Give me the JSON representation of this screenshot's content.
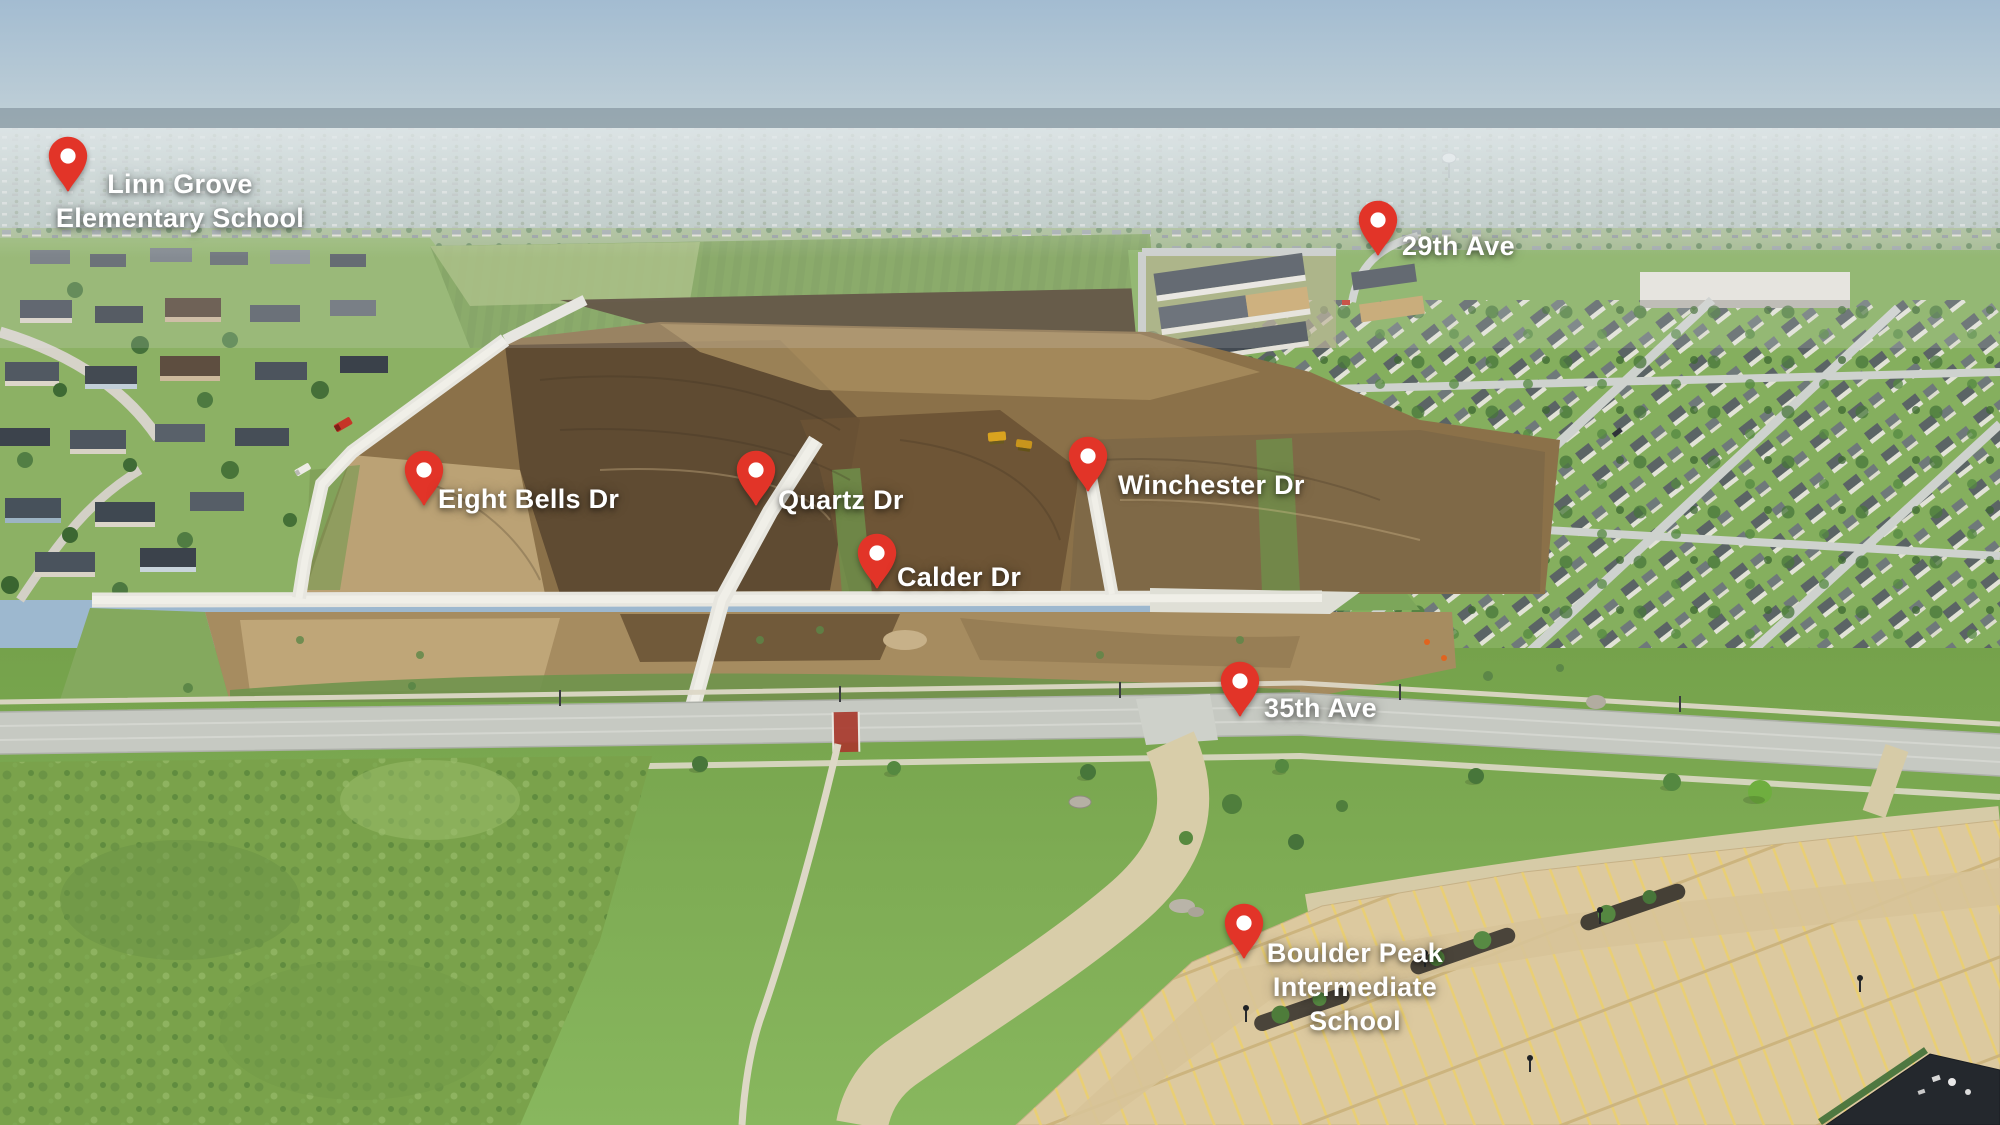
{
  "image": {
    "type": "annotated-aerial-photo",
    "description": "Aerial drone view of a residential construction development with labeled streets and schools"
  },
  "colors": {
    "pin": "#e23428",
    "pin_hole": "#ffffff",
    "label_text": "#ffffff",
    "sky": "#a3bcd1",
    "dirt": "#8b7149",
    "road_concrete": "#e7e6df",
    "asphalt": "#c6c9c2",
    "lawn": "#7aa74f",
    "parking_lot": "#dcc99f"
  },
  "markers": [
    {
      "id": "linn-grove-elementary",
      "label": "Linn Grove\nElementary School",
      "x": 68,
      "y": 193
    },
    {
      "id": "29th-ave",
      "label": "29th Ave",
      "x": 1378,
      "y": 257
    },
    {
      "id": "eight-bells-dr",
      "label": "Eight Bells Dr",
      "x": 424,
      "y": 507
    },
    {
      "id": "quartz-dr",
      "label": "Quartz Dr",
      "x": 756,
      "y": 507
    },
    {
      "id": "winchester-dr",
      "label": "Winchester Dr",
      "x": 1088,
      "y": 493
    },
    {
      "id": "calder-dr",
      "label": "Calder Dr",
      "x": 877,
      "y": 590
    },
    {
      "id": "35th-ave",
      "label": "35th Ave",
      "x": 1240,
      "y": 718
    },
    {
      "id": "boulder-peak-intermediate",
      "label": "Boulder Peak\nIntermediate\nSchool",
      "x": 1244,
      "y": 960
    }
  ]
}
